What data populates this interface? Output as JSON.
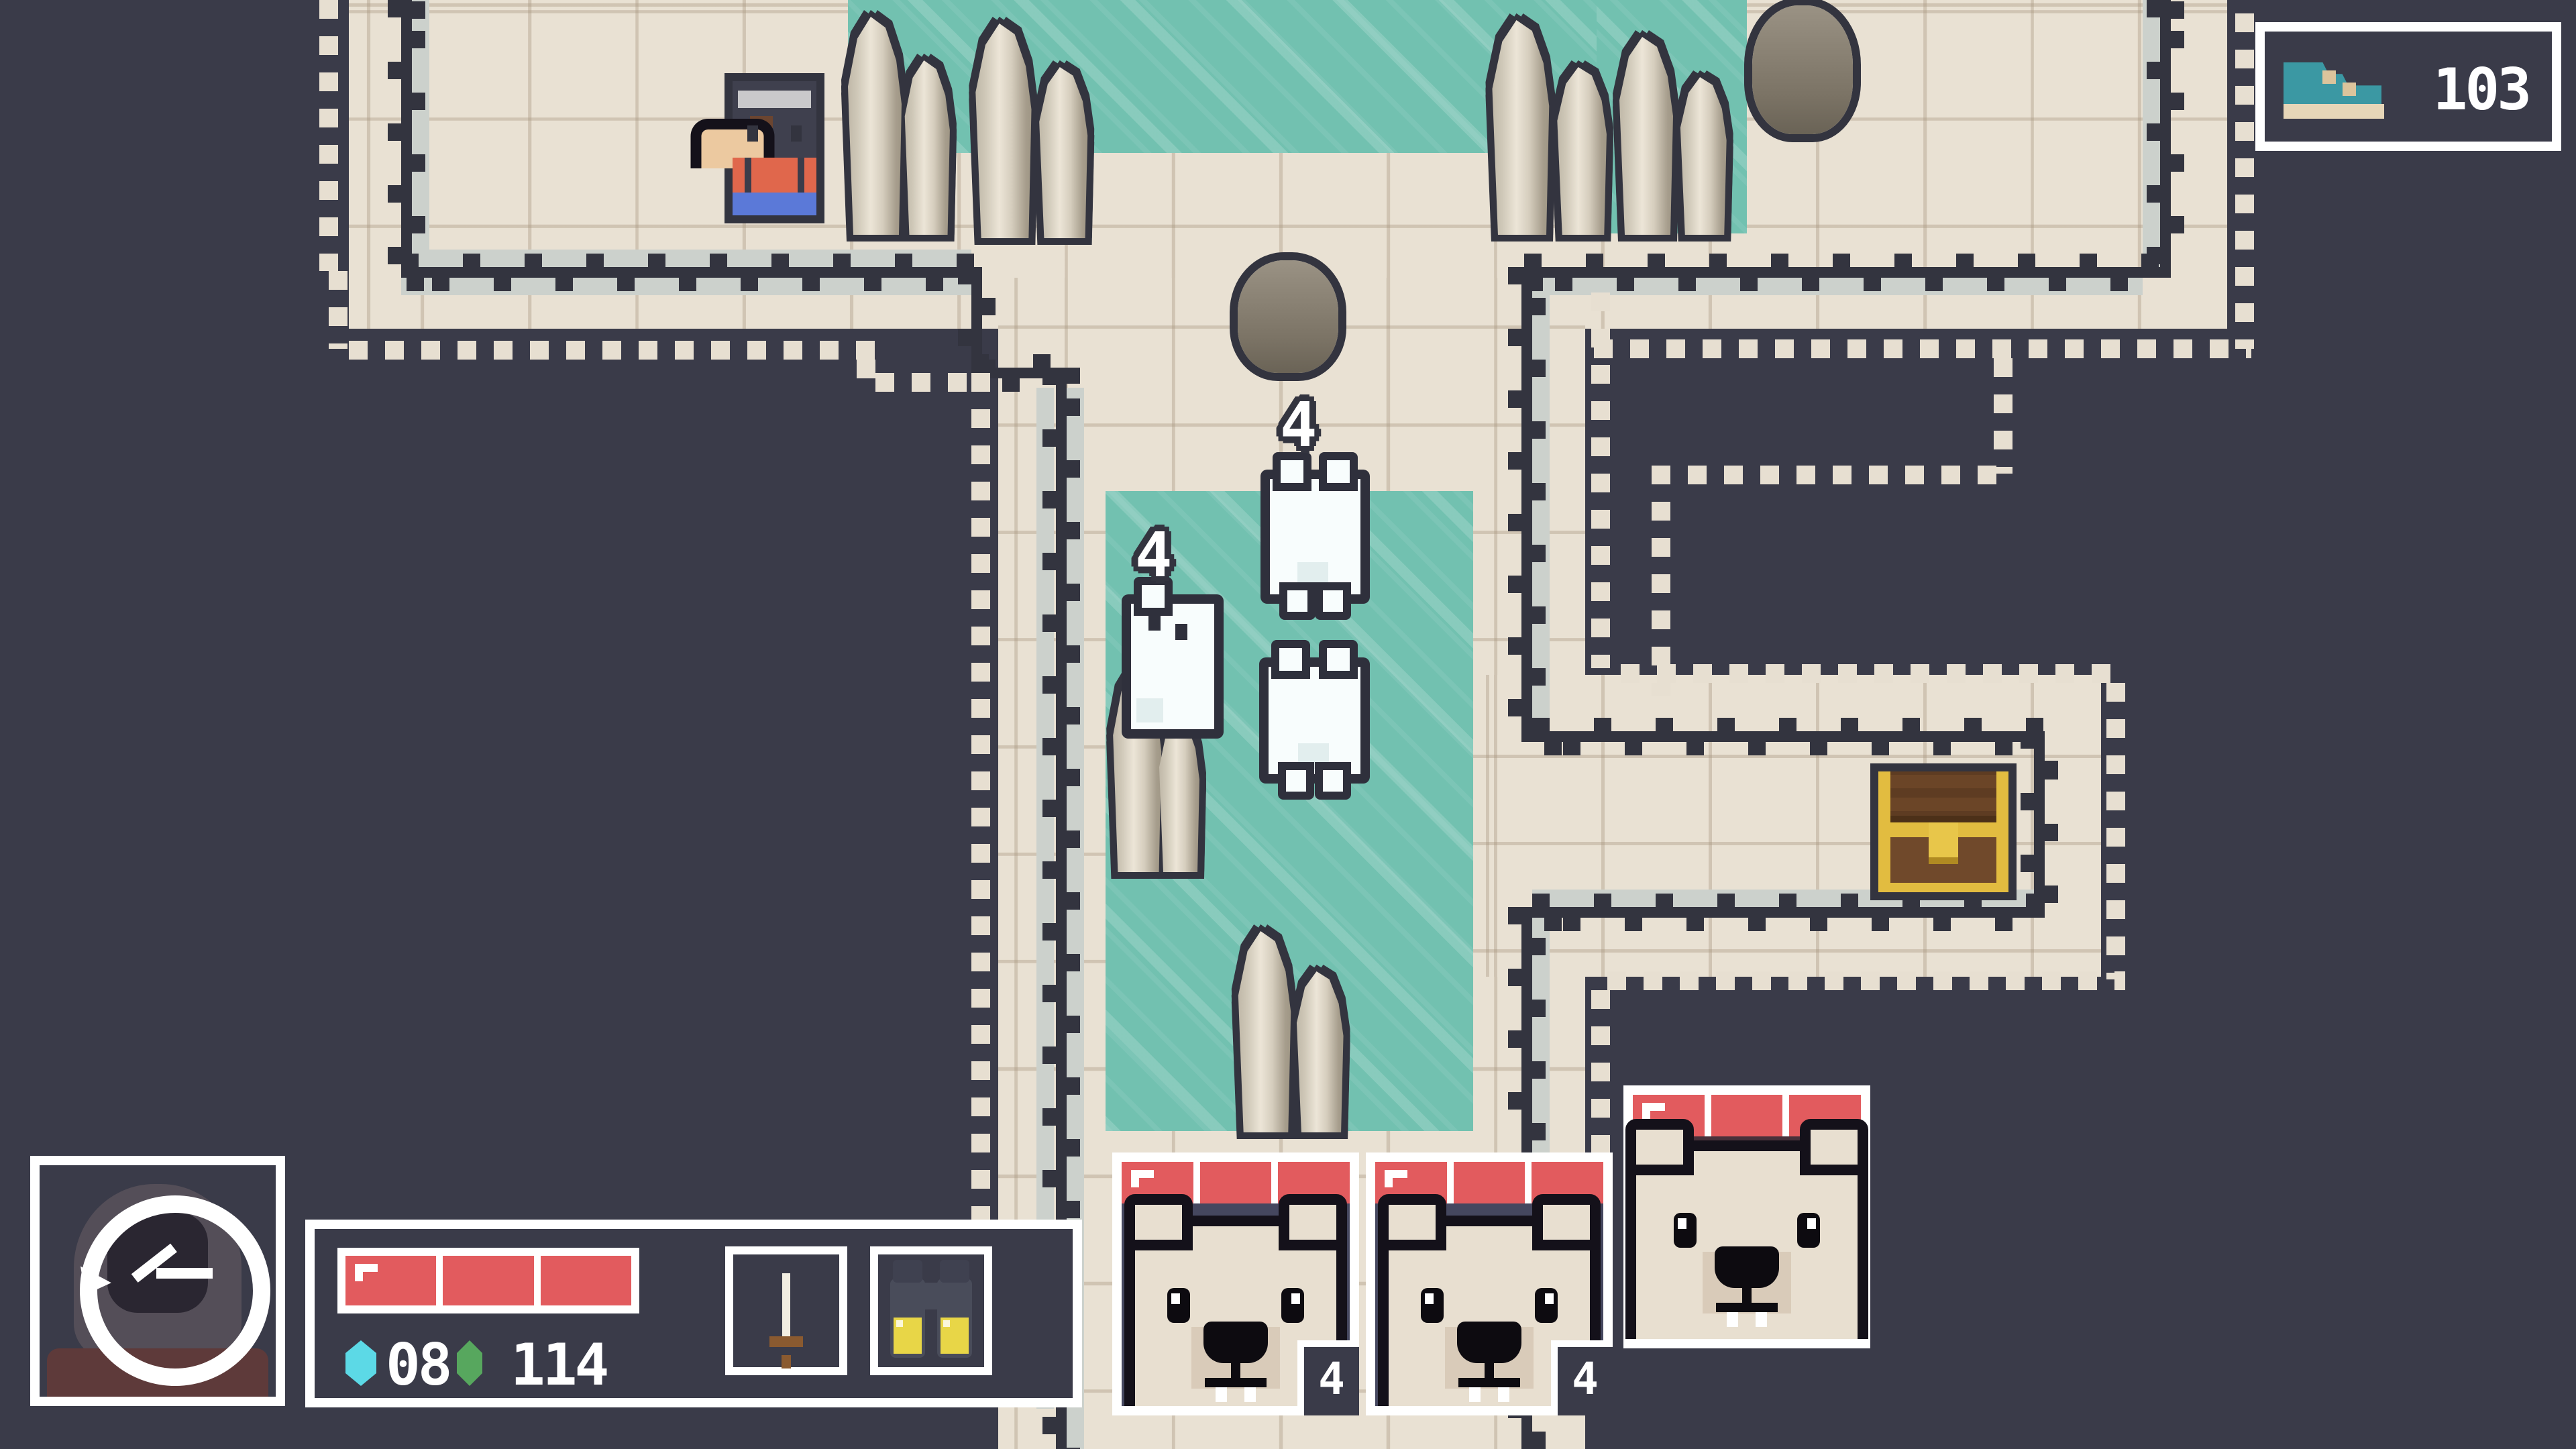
{
  "hud": {
    "shoe_counter": {
      "icon": "sneaker-icon",
      "value": "103"
    },
    "resources": {
      "cyan_gems": "08",
      "green_gems": "114"
    },
    "inventory": {
      "slot1": "sword",
      "slot2": "binoculars"
    },
    "player": {
      "hp_segments": 3,
      "portrait_icon": "clock-icon"
    },
    "party": {
      "cards": [
        {
          "hp_segments": 3,
          "stack_count": "4",
          "variant": "blue"
        },
        {
          "hp_segments": 3,
          "stack_count": "4",
          "variant": "blue"
        },
        {
          "hp_segments": 3,
          "stack_count": "",
          "variant": "maroon"
        }
      ]
    }
  },
  "map": {
    "enemy_labels": [
      {
        "value": "4"
      },
      {
        "value": "4"
      }
    ],
    "features": [
      "ice-pools",
      "stalagmites",
      "boulders",
      "treasure-chest",
      "polar-bears",
      "player-character"
    ]
  },
  "colors": {
    "background_navy": "#3a3b49",
    "wall_dark": "#33343f",
    "floor_cream": "#e9e1d3",
    "water_teal": "#72c1b0",
    "hp_red": "#e25b5e",
    "card_blue": "#45475f",
    "card_maroon": "#48303a",
    "chest_gold": "#e2bc40",
    "shoe_teal": "#3b98a3",
    "gem_cyan": "#5cd9e6",
    "gem_green": "#57a75e",
    "lens_yellow": "#e8d647"
  }
}
